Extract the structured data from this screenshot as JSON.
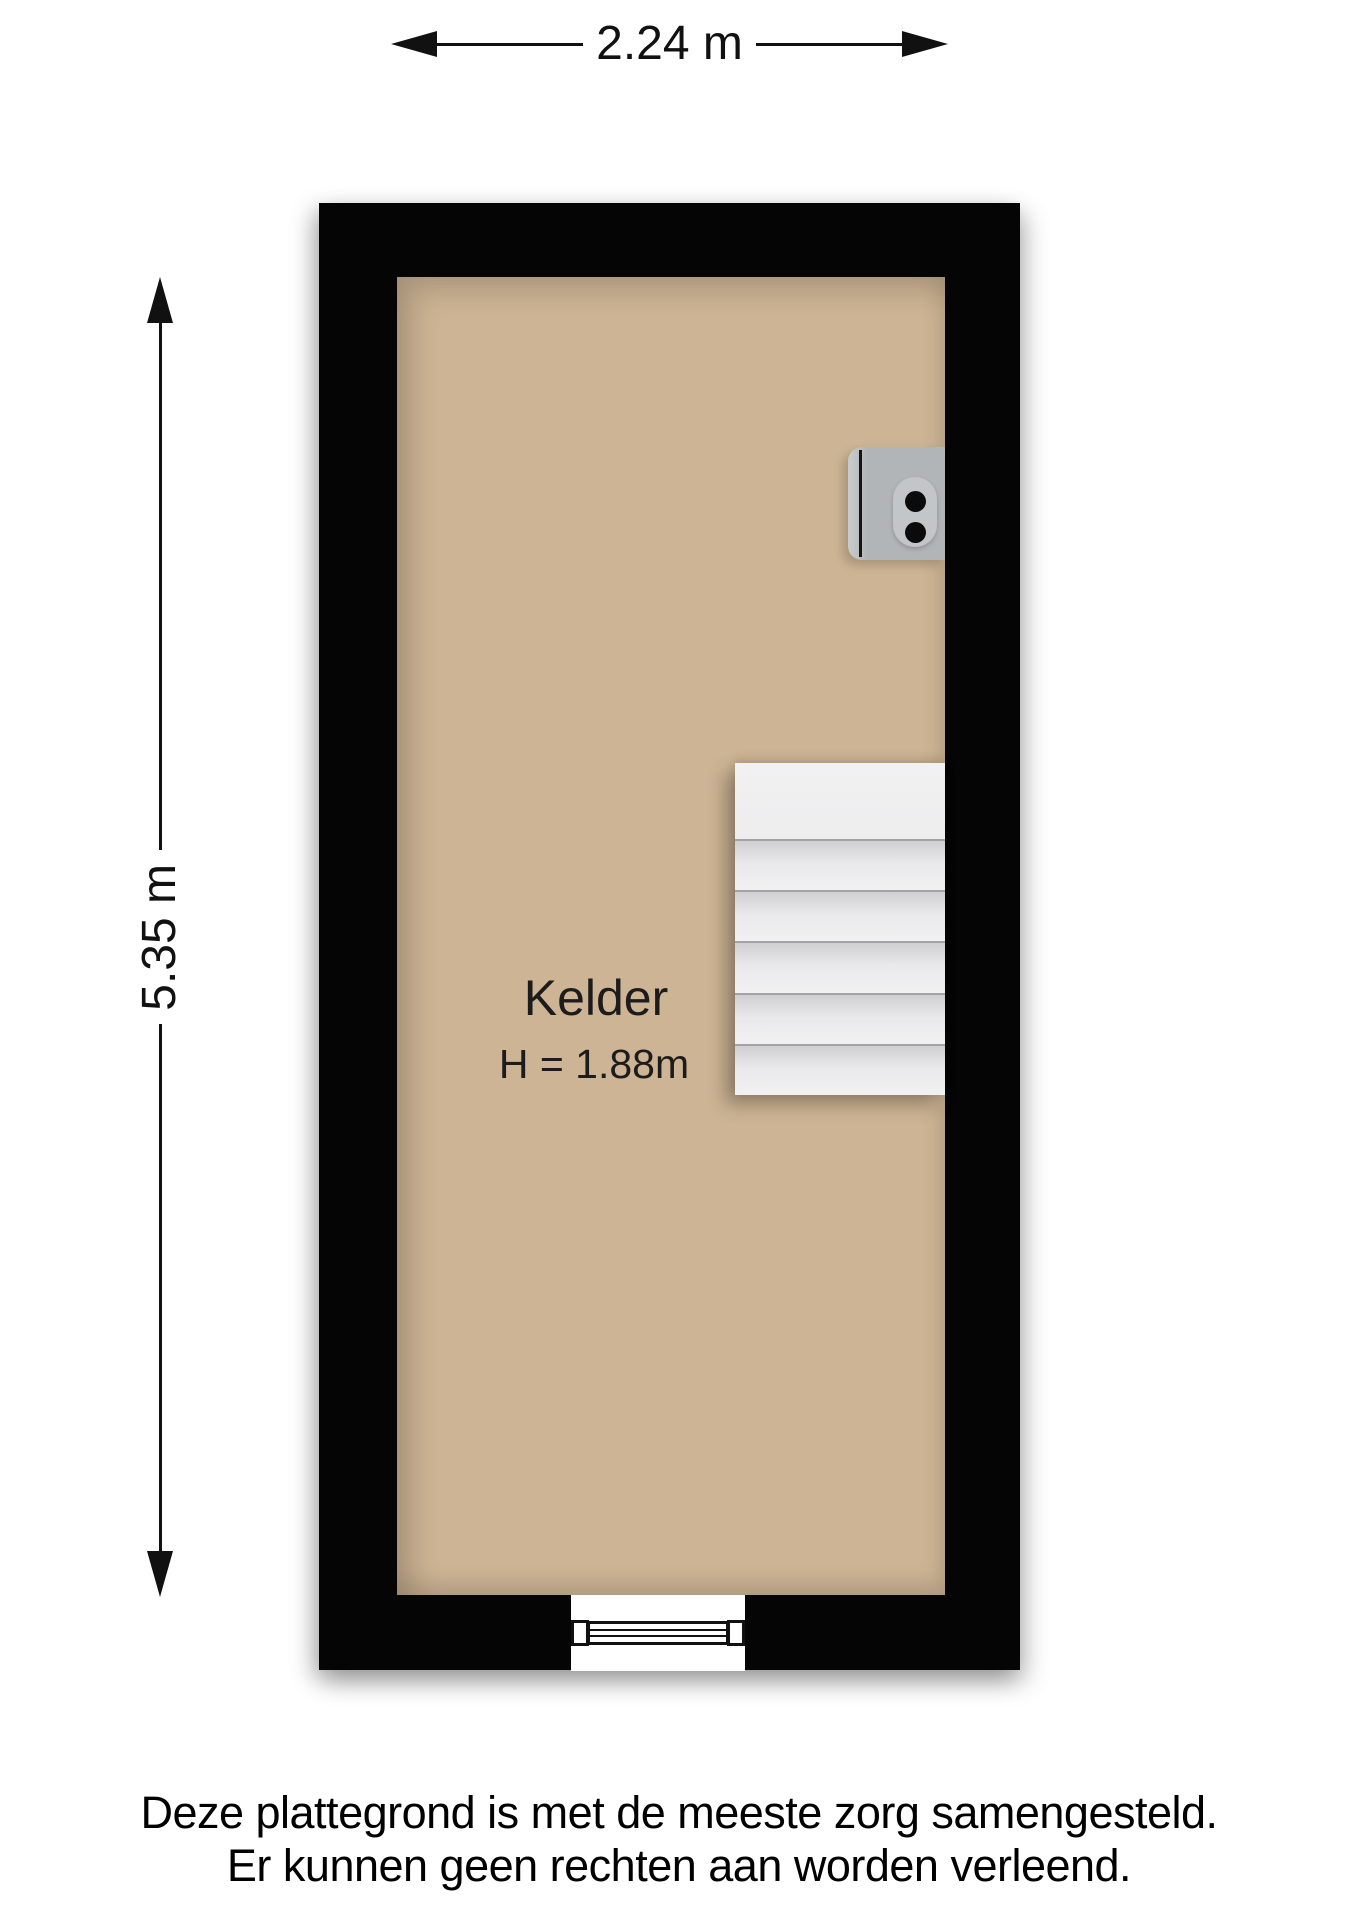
{
  "dimensions": {
    "width_label": "2.24 m",
    "height_label": "5.35 m"
  },
  "room": {
    "name": "Kelder",
    "ceiling_height_label": "H = 1.88m"
  },
  "stairs": {
    "step_count": 5
  },
  "disclaimer": {
    "line1": "Deze plattegrond is met de meeste zorg samengesteld.",
    "line2": "Er kunnen geen rechten aan worden verleend."
  },
  "colors": {
    "page": "#ffffff",
    "wall": "#050505",
    "floor": "#cdb494",
    "stair-tread": "#f0f0f1",
    "fixture": "#b2b5b7"
  }
}
